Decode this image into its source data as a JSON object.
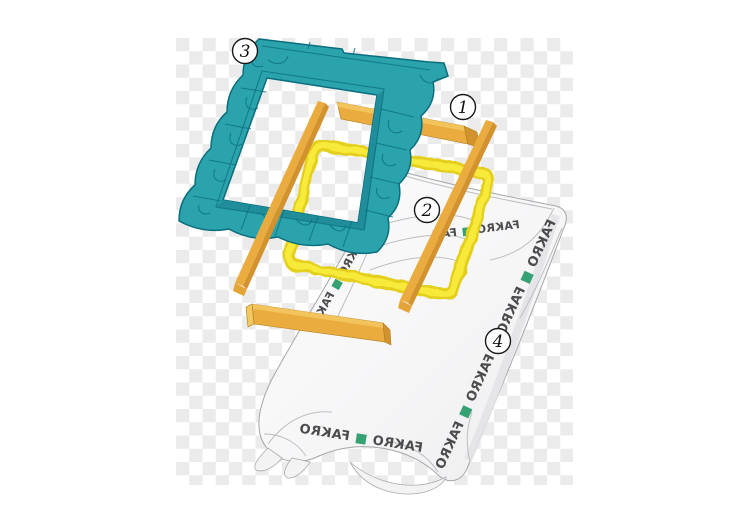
{
  "diagram": {
    "brand": "FAKRO",
    "callouts": [
      {
        "number": "1"
      },
      {
        "number": "2"
      },
      {
        "number": "3"
      },
      {
        "number": "4"
      }
    ],
    "bands": {
      "right": "FAKRO ■ FAKRO ■ FAKRO ■ FAKRO",
      "bottom": "FAKRO ■ FAKRO",
      "left": "FAKRO ■ FAKRO ■ FAKRO",
      "top": "FAKRO ■ FAK"
    }
  },
  "colors": {
    "teal": "#2AA3AC",
    "teal_dark": "#0B6E7D",
    "teal_lip": "#1F8E9A",
    "batten_main": "#EAAC3E",
    "batten_light": "#F4C45C",
    "batten_dark": "#D2932F",
    "yellow_outer": "#E3CF1B",
    "yellow_inner": "#F8EA3A",
    "green": "#36A173",
    "text_gray": "#4B4B4D",
    "membrane_fill_hi": "#FCFCFD",
    "membrane_fill_lo": "#EDEDEF",
    "membrane_stroke": "#A3A7A9",
    "checker_gray": "#EBEBEB",
    "checker_white": "#FFFFFF"
  }
}
